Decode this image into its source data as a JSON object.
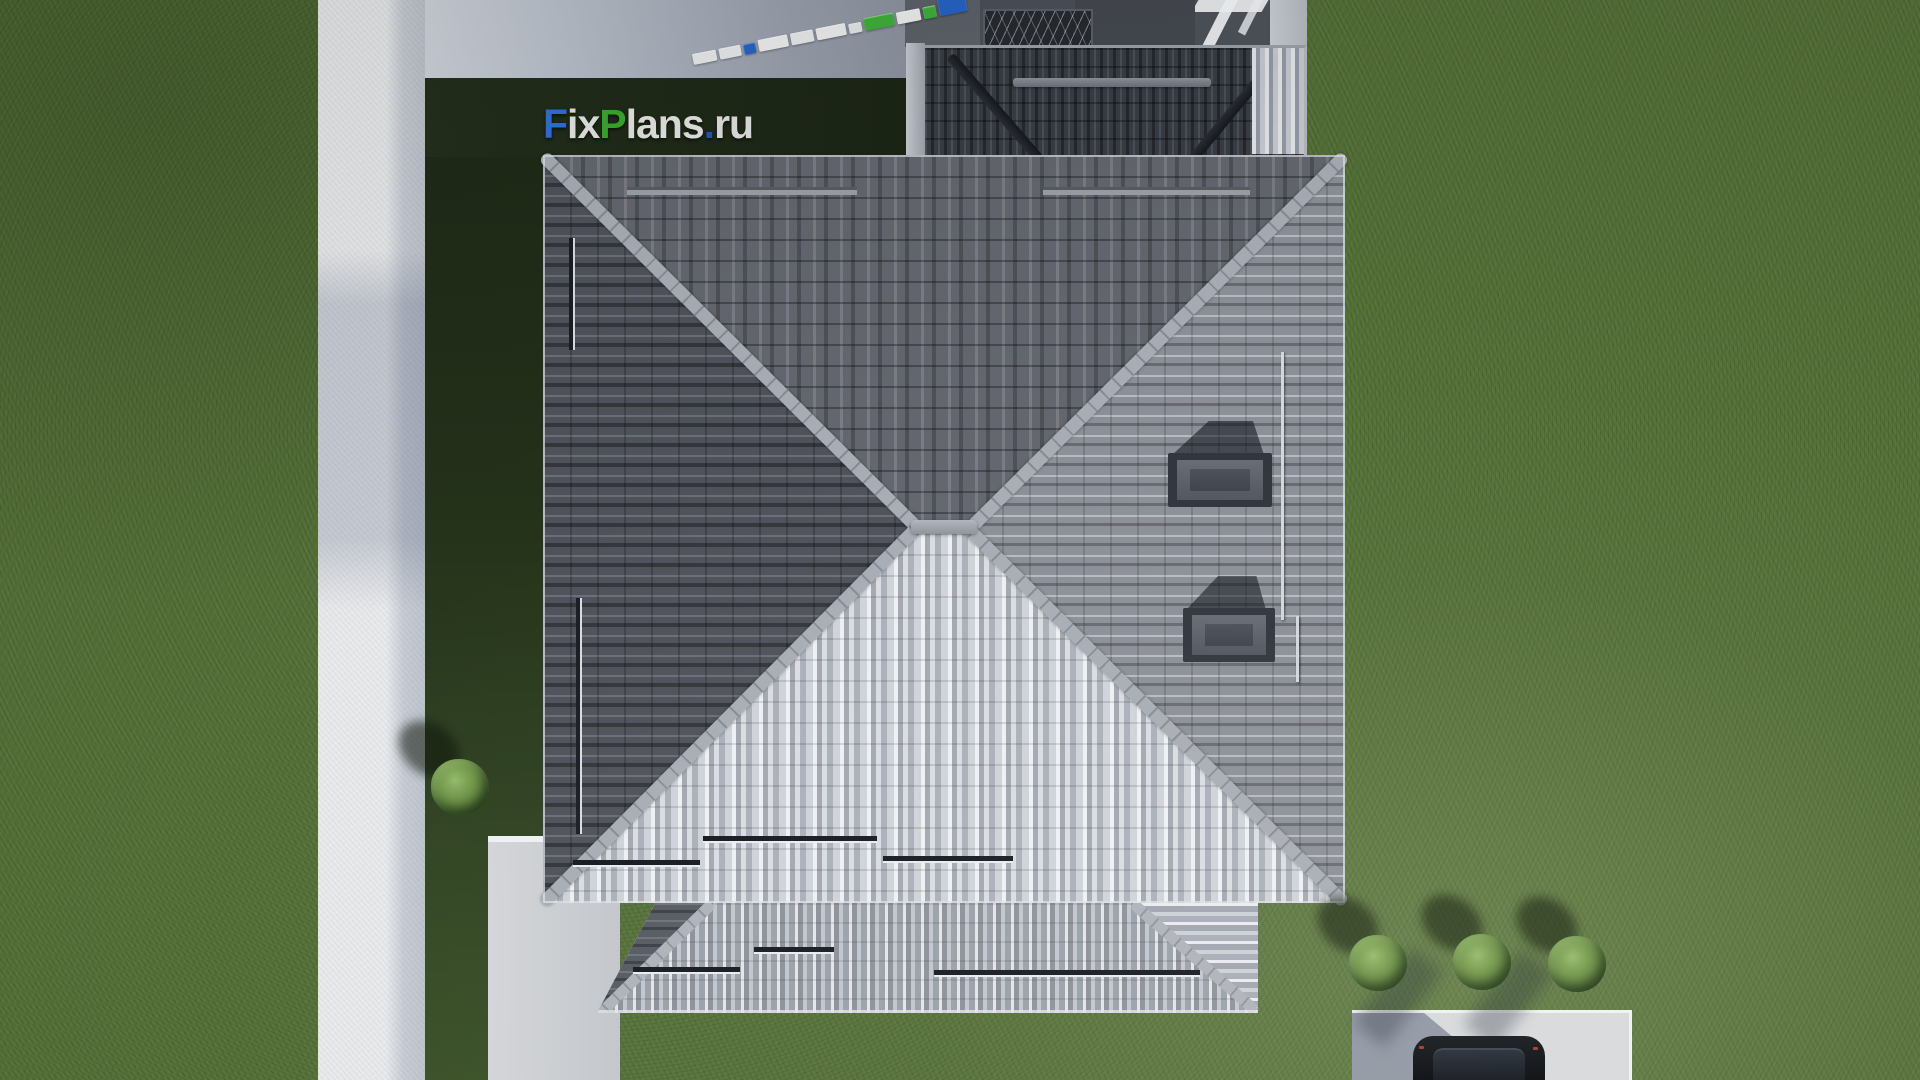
{
  "watermark": {
    "text": "FixPlans.ru",
    "parts": [
      {
        "text": "F",
        "color": "#2f6fd6"
      },
      {
        "text": "ix",
        "color": "#e3e4e2"
      },
      {
        "text": "P",
        "color": "#38a82b"
      },
      {
        "text": "lans",
        "color": "#e3e4e2"
      },
      {
        "text": ".",
        "color": "#2456b0"
      },
      {
        "text": "ru",
        "color": "#dfe0de"
      }
    ]
  },
  "measuring_tape": {
    "segments": [
      {
        "color": "#e8e9ea"
      },
      {
        "color": "#e8e9ea"
      },
      {
        "color": "#2563c4"
      },
      {
        "color": "#eceded"
      },
      {
        "color": "#e8e9ea"
      },
      {
        "color": "#eceded"
      },
      {
        "color": "#e4e5e6"
      },
      {
        "color": "#3fae3a"
      },
      {
        "color": "#eceded"
      },
      {
        "color": "#3fae3a"
      },
      {
        "color": "#2563c4"
      }
    ]
  },
  "scene": {
    "view": "top-down 3d architectural render of a hipped-roof house",
    "house": {
      "roof_type": "hipped",
      "skylights": 2,
      "snow_guard_bars": 12,
      "colors": {
        "north_slope": "#63666e",
        "west_slope": "#4f525a",
        "east_slope": "#8b8f97",
        "south_slope": "#bcc0c7",
        "porch_slope": "#9a9ea6",
        "garage_slope": "#383c44",
        "hip_caps": "#9aa0a8"
      }
    },
    "ground": {
      "grass": "#57723a",
      "grass_shadow": "#222d19",
      "sidewalk": "#e7e8ea",
      "driveway": "#aeb4c0",
      "terrace_paving": "#484c54",
      "parking_pad": "#d7d9db"
    },
    "landscaping": {
      "bushes": 4,
      "bush_color": "#6d914b"
    },
    "vehicle": {
      "type": "car",
      "color": "#0c0e11"
    }
  }
}
